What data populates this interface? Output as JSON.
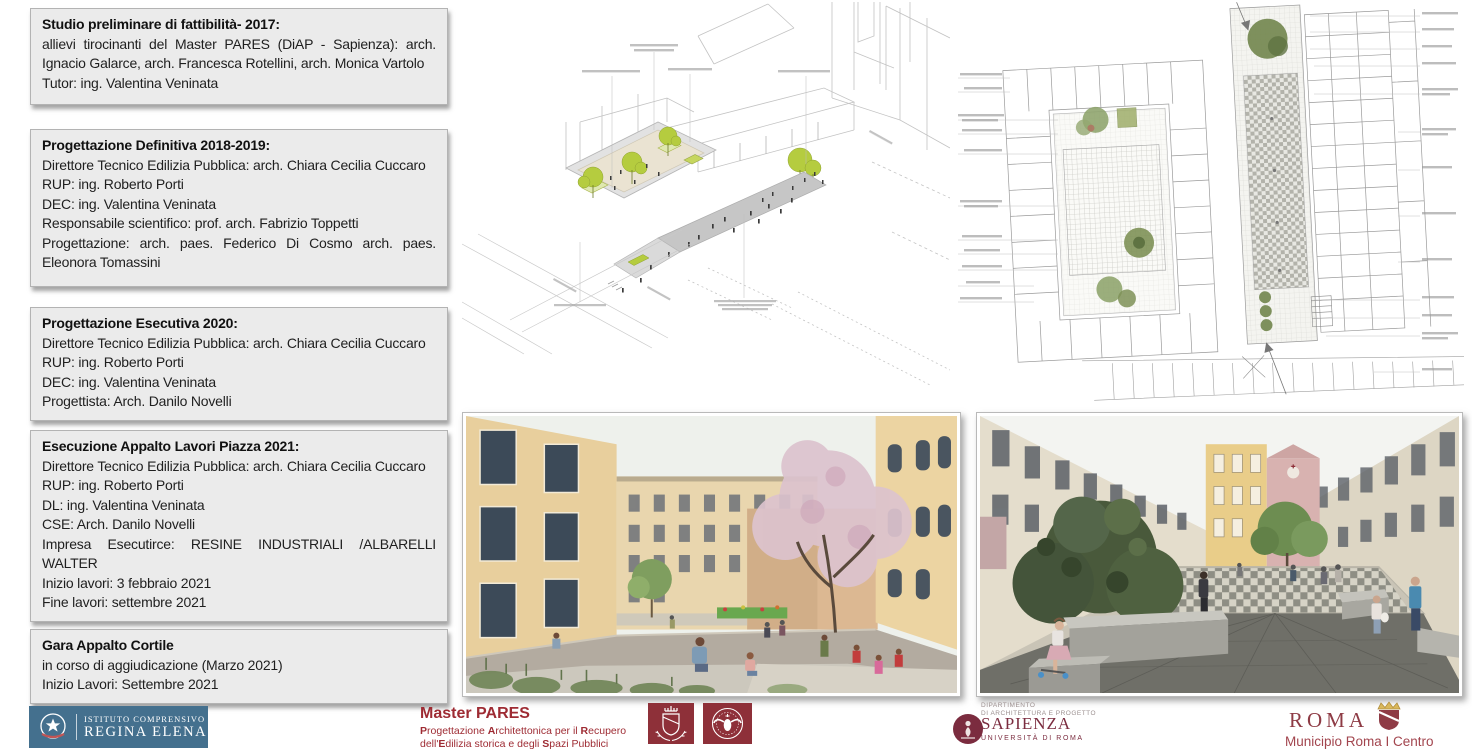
{
  "timeline_boxes": [
    {
      "title": "Studio preliminare di fattibilità- 2017:",
      "lines": [
        "allievi tirocinanti del Master PARES (DiAP - Sapienza): arch. Ignacio Galarce, arch. Francesca Rotellini, arch. Monica Vartolo",
        "Tutor: ing. Valentina Veninata"
      ]
    },
    {
      "title": "Progettazione Definitiva 2018-2019:",
      "lines": [
        "Direttore Tecnico Edilizia Pubblica:  arch. Chiara Cecilia Cuccaro",
        "RUP: ing. Roberto Porti",
        "DEC: ing. Valentina Veninata",
        "Responsabile scientifico: prof. arch. Fabrizio Toppetti",
        "Progettazione:  arch. paes. Federico Di Cosmo arch. paes. Eleonora Tomassini"
      ]
    },
    {
      "title": "Progettazione Esecutiva 2020:",
      "lines": [
        "Direttore Tecnico Edilizia Pubblica:  arch. Chiara Cecilia Cuccaro",
        "RUP: ing. Roberto Porti",
        "DEC: ing. Valentina Veninata",
        "Progettista: Arch. Danilo Novelli"
      ]
    },
    {
      "title": "Esecuzione Appalto Lavori Piazza 2021:",
      "lines": [
        "Direttore Tecnico Edilizia Pubblica:  arch. Chiara Cecilia Cuccaro",
        "RUP: ing. Roberto Porti",
        "DL: ing. Valentina Veninata",
        "CSE: Arch. Danilo Novelli",
        "Impresa Esecutirce: RESINE INDUSTRIALI /ALBARELLI WALTER",
        "Inizio lavori: 3 febbraio 2021",
        "Fine lavori: settembre 2021"
      ]
    },
    {
      "title": "Gara Appalto Cortile",
      "lines": [
        "in corso di aggiudicazione (Marzo 2021)",
        "Inizio Lavori: Settembre 2021"
      ]
    }
  ],
  "footer": {
    "school": {
      "line1": "ISTITUTO COMPRENSIVO",
      "line2": "REGINA ELENA"
    },
    "master": {
      "title": "Master PARES",
      "subtitle": [
        [
          {
            "t": "P",
            "b": 1
          },
          {
            "t": "rogettazione "
          },
          {
            "t": "A",
            "b": 1
          },
          {
            "t": "rchitettonica per il "
          },
          {
            "t": "R",
            "b": 1
          },
          {
            "t": "ecupero"
          }
        ],
        [
          {
            "t": "dell'"
          },
          {
            "t": "E",
            "b": 1
          },
          {
            "t": "dilizia storica e degli "
          },
          {
            "t": "S",
            "b": 1
          },
          {
            "t": "pazi Pubblici"
          }
        ]
      ]
    },
    "department": {
      "line1": "DIPARTIMENTO",
      "line2": "DI ARCHITETTURA E PROGETTO",
      "university": "SAPIENZA",
      "university_sub": "UNIVERSITÀ DI ROMA"
    },
    "municipio": {
      "city": "ROMA",
      "sub": "Municipio Roma I Centro"
    }
  },
  "colors": {
    "box_gray": "#ebebeb",
    "accent_red": "#9e2b33",
    "crest_red": "#8e3039",
    "school_blue": "#44708e",
    "sapienza_maroon": "#7b2c3f",
    "tree_green": "#b5cc3f"
  }
}
